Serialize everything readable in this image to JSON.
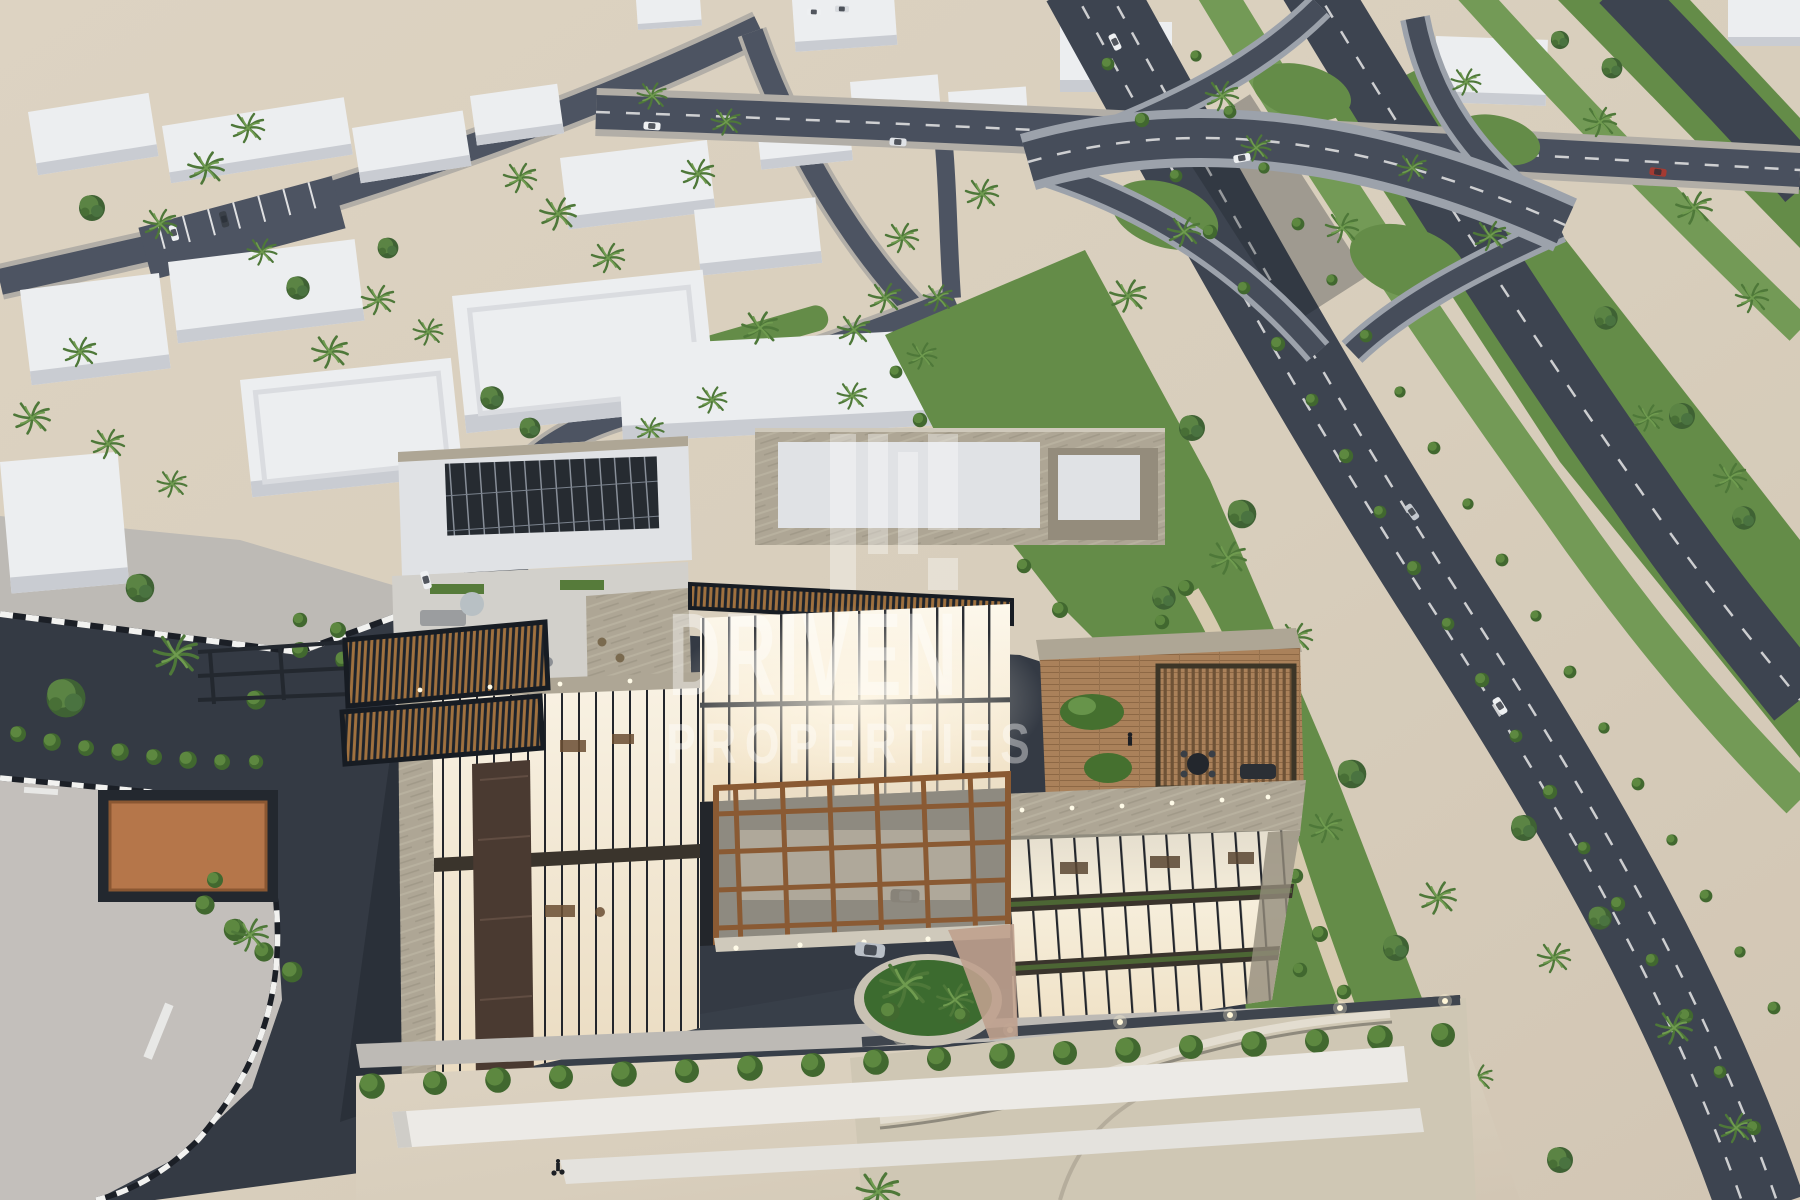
{
  "watermark": {
    "brand": "DRIVEN",
    "subtitle": "PROPERTIES",
    "logo": "driven-properties-logo",
    "color": "#ffffff",
    "opacity": 0.42
  },
  "scene": {
    "description": "Dusk aerial 3D architectural rendering of a modern luxury glass-and-travertine building with lit interiors, rooftop terraces, pergolas and solar panels, set between a desert low-rise district with palm trees on the left and a landscaped green belt with a highway interchange on the right. Semi-transparent DRIVEN PROPERTIES watermark over the building.",
    "elements": [
      "desert-ground",
      "city-blocks",
      "street-network",
      "parking-bays",
      "highway-interchange",
      "flyover-bridge",
      "greenbelt-park",
      "garden-path",
      "median-planting",
      "main-building",
      "left-wing",
      "right-wing",
      "glass-atrium",
      "entrance-canopy",
      "louvered-bridge",
      "rooftop-terrace",
      "pergola",
      "solar-panels",
      "forecourt-driveway",
      "roundabout-island",
      "sidewalks",
      "curb-striping",
      "hedge-row",
      "perimeter-wall",
      "basement-ramp",
      "circular-planter",
      "palm-trees",
      "trees",
      "shrubs",
      "vehicles",
      "pedestrian",
      "wall-lights",
      "watermark"
    ]
  },
  "palette": {
    "sand": "#d8cebc",
    "sand_light": "#e2d9c8",
    "sidewalk": "#bdbab5",
    "island": "#c3bfbb",
    "street": "#4d5462",
    "street_casing": "#b2aea7",
    "asphalt": "#343a44",
    "asphalt_light": "#3d434e",
    "curb_white": "#f2f2f0",
    "grass": "#648c48",
    "grass_bright": "#739a56",
    "bush": "#45702f",
    "bush_light": "#67944a",
    "tree": "#3f6234",
    "palm": "#4e7839",
    "palm_light": "#6f9b4f",
    "white_face": "#eceef0",
    "white_shade": "#c9ccd2",
    "roof_white": "#e0e2e5",
    "travertine": "#aea695",
    "travertine_dark": "#948c7c",
    "glass_warm": "#f4ead6",
    "glass_bright": "#faf3e4",
    "glass_dark": "#2f3338",
    "mullion": "#23262c",
    "wood": "#8a5a33",
    "deck": "#aa815a",
    "louvre": "#a0713f",
    "frame_dark": "#23282f",
    "highway": "#3d4450",
    "concrete": "#9ca2ab",
    "brick": "#bfa18e",
    "apron": "#cfc7b4",
    "wall_white": "#eceae6",
    "marble_dark": "#4a3a31",
    "car_white": "#eef0f2",
    "car_silver": "#b9bfc7",
    "car_red": "#a43a32"
  }
}
